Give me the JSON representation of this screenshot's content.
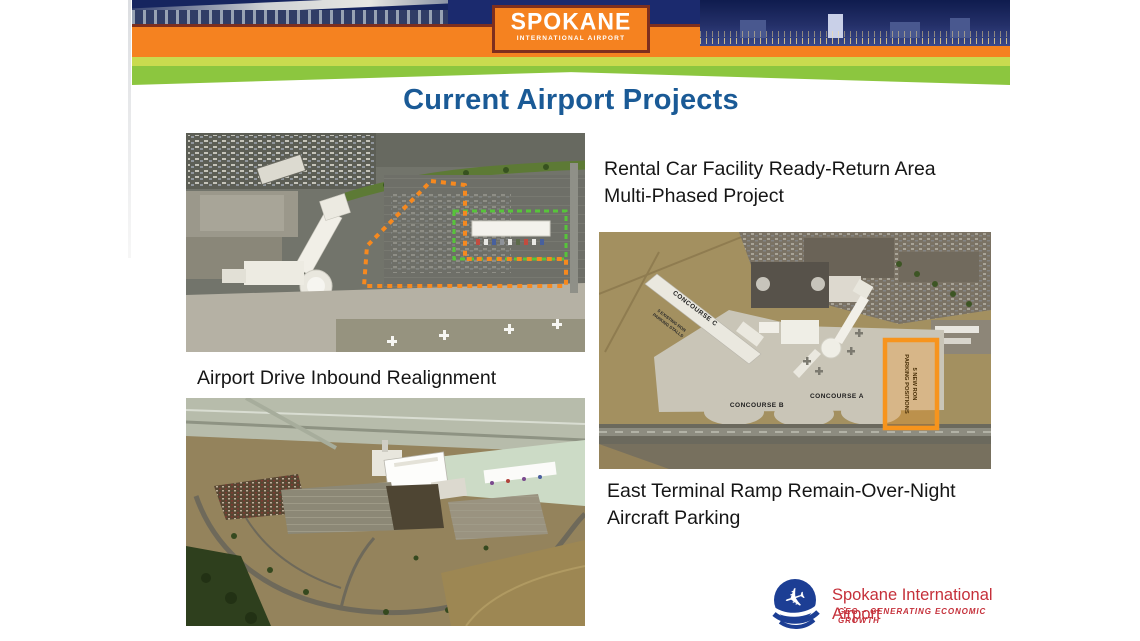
{
  "banner": {
    "logo_title": "SPOKANE",
    "logo_subtitle": "INTERNATIONAL AIRPORT"
  },
  "title": "Current Airport Projects",
  "captions": {
    "rental_line1": "Rental Car Facility Ready-Return Area",
    "rental_line2": "Multi-Phased Project",
    "airport_drive": "Airport Drive Inbound Realignment",
    "east_line1": "East Terminal Ramp Remain-Over-Night",
    "east_line2": "Aircraft Parking"
  },
  "map_labels": {
    "concourse_a": "CONCOURSE A",
    "concourse_b": "CONCOURSE B",
    "concourse_c": "CONCOURSE C",
    "ron_new_line1": "5 NEW RON",
    "ron_new_line2": "PARKING POSITIONS",
    "ron_existing_line1": "5 EXISTING RON",
    "ron_existing_line2": "PARKING STALLS"
  },
  "footer_logo": {
    "name": "Spokane International Airport",
    "tagline": "GEG – GENERATING ECONOMIC GROWTH"
  },
  "colors": {
    "title_blue": "#1A5A96",
    "banner_orange": "#F58220",
    "banner_brown": "#7E2F1E",
    "banner_light_green": "#C9DB4F",
    "banner_green": "#8CC63F",
    "highlight_orange": "#F7941D",
    "dash_green": "#57C43A",
    "logo_red": "#C5303A",
    "logo_blue": "#1C3E94"
  }
}
